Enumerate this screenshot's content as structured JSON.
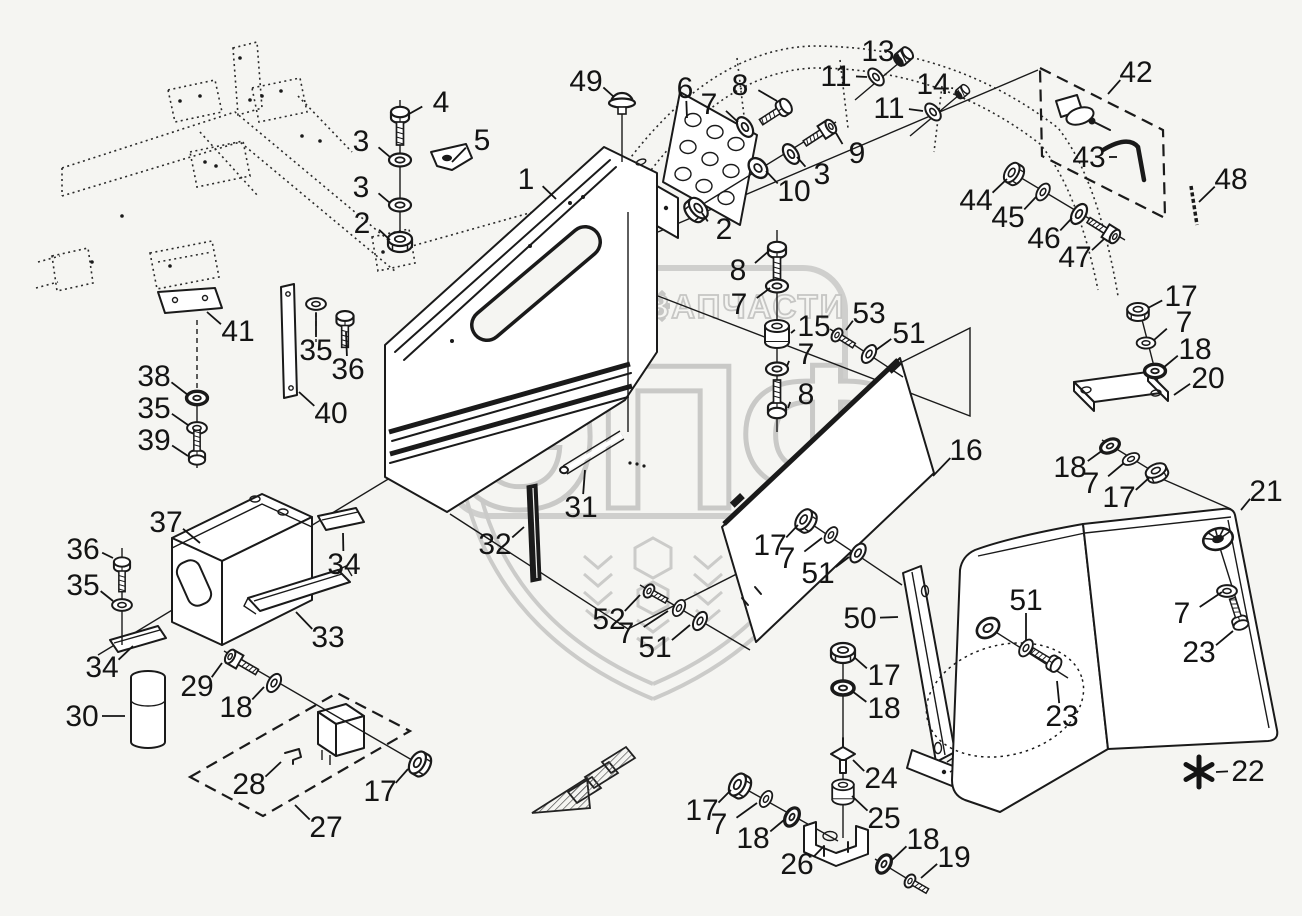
{
  "watermark": {
    "left_text": "ТЕХНИКА",
    "right_text": "ЗАПЧАСТИ",
    "logo_text": "ЭПФ",
    "gear_icon": "⚙",
    "color": "#c9c9c7"
  },
  "diagram": {
    "footnote_marker": "*",
    "line_color": "#1a1a1a",
    "background_color": "#f5f5f2",
    "callouts": [
      {
        "n": "4",
        "x": 441,
        "y": 102,
        "tx": 409,
        "ty": 114
      },
      {
        "n": "5",
        "x": 482,
        "y": 140,
        "tx": 452,
        "ty": 162
      },
      {
        "n": "3",
        "x": 361,
        "y": 141,
        "tx": 390,
        "ty": 157
      },
      {
        "n": "3",
        "x": 361,
        "y": 187,
        "tx": 390,
        "ty": 203
      },
      {
        "n": "2",
        "x": 362,
        "y": 223,
        "tx": 390,
        "ty": 240
      },
      {
        "n": "49",
        "x": 586,
        "y": 81,
        "tx": 614,
        "ty": 97
      },
      {
        "n": "1",
        "x": 526,
        "y": 179,
        "tx": 556,
        "ty": 199
      },
      {
        "n": "6",
        "x": 685,
        "y": 88,
        "tx": 687,
        "ty": 118
      },
      {
        "n": "7",
        "x": 709,
        "y": 104,
        "tx": 738,
        "ty": 122
      },
      {
        "n": "8",
        "x": 740,
        "y": 85,
        "tx": 777,
        "ty": 101
      },
      {
        "n": "9",
        "x": 857,
        "y": 153,
        "tx": 836,
        "ty": 133
      },
      {
        "n": "3",
        "x": 822,
        "y": 174,
        "tx": 797,
        "ty": 157
      },
      {
        "n": "10",
        "x": 794,
        "y": 191,
        "tx": 766,
        "ty": 171
      },
      {
        "n": "2",
        "x": 724,
        "y": 229,
        "tx": 702,
        "ty": 213
      },
      {
        "n": "8",
        "x": 738,
        "y": 270,
        "tx": 770,
        "ty": 250
      },
      {
        "n": "7",
        "x": 739,
        "y": 304,
        "tx": 770,
        "ty": 288
      },
      {
        "n": "15",
        "x": 814,
        "y": 326,
        "tx": 791,
        "ty": 333
      },
      {
        "n": "7",
        "x": 806,
        "y": 354,
        "tx": 787,
        "ty": 366
      },
      {
        "n": "8",
        "x": 806,
        "y": 394,
        "tx": 788,
        "ty": 408
      },
      {
        "n": "53",
        "x": 869,
        "y": 313,
        "tx": 846,
        "ty": 330
      },
      {
        "n": "51",
        "x": 909,
        "y": 333,
        "tx": 876,
        "ty": 350
      },
      {
        "n": "13",
        "x": 878,
        "y": 51,
        "tx": 897,
        "ty": 56
      },
      {
        "n": "11",
        "x": 836,
        "y": 76,
        "tx": 867,
        "ty": 77
      },
      {
        "n": "14",
        "x": 933,
        "y": 84,
        "tx": 952,
        "ty": 89
      },
      {
        "n": "11",
        "x": 889,
        "y": 108,
        "tx": 923,
        "ty": 111
      },
      {
        "n": "42",
        "x": 1136,
        "y": 72,
        "tx": 1108,
        "ty": 94
      },
      {
        "n": "43",
        "x": 1089,
        "y": 157,
        "tx": 1117,
        "ty": 157
      },
      {
        "n": "48",
        "x": 1231,
        "y": 179,
        "tx": 1199,
        "ty": 202
      },
      {
        "n": "44",
        "x": 976,
        "y": 200,
        "tx": 1007,
        "ty": 179
      },
      {
        "n": "45",
        "x": 1008,
        "y": 217,
        "tx": 1036,
        "ty": 197
      },
      {
        "n": "46",
        "x": 1044,
        "y": 238,
        "tx": 1072,
        "ty": 218
      },
      {
        "n": "47",
        "x": 1075,
        "y": 257,
        "tx": 1104,
        "ty": 239
      },
      {
        "n": "17",
        "x": 1181,
        "y": 296,
        "tx": 1148,
        "ty": 308
      },
      {
        "n": "7",
        "x": 1184,
        "y": 322,
        "tx": 1154,
        "ty": 340
      },
      {
        "n": "18",
        "x": 1195,
        "y": 349,
        "tx": 1163,
        "ty": 368
      },
      {
        "n": "20",
        "x": 1208,
        "y": 378,
        "tx": 1174,
        "ty": 395
      },
      {
        "n": "18",
        "x": 1070,
        "y": 467,
        "tx": 1103,
        "ty": 450
      },
      {
        "n": "7",
        "x": 1091,
        "y": 483,
        "tx": 1124,
        "ty": 463
      },
      {
        "n": "17",
        "x": 1119,
        "y": 497,
        "tx": 1150,
        "ty": 477
      },
      {
        "n": "16",
        "x": 966,
        "y": 450,
        "tx": 933,
        "ty": 476
      },
      {
        "n": "21",
        "x": 1266,
        "y": 491,
        "tx": 1241,
        "ty": 510
      },
      {
        "n": "51",
        "x": 1026,
        "y": 600,
        "tx": 1026,
        "ty": 640
      },
      {
        "n": "7",
        "x": 1182,
        "y": 613,
        "tx": 1222,
        "ty": 592
      },
      {
        "n": "23",
        "x": 1199,
        "y": 652,
        "tx": 1233,
        "ty": 631
      },
      {
        "n": "23",
        "x": 1062,
        "y": 716,
        "tx": 1057,
        "ty": 681
      },
      {
        "n": "22",
        "x": 1248,
        "y": 771,
        "tx": 1216,
        "ty": 772
      },
      {
        "n": "41",
        "x": 238,
        "y": 331,
        "tx": 207,
        "ty": 312
      },
      {
        "n": "35",
        "x": 316,
        "y": 350,
        "tx": 316,
        "ty": 313
      },
      {
        "n": "36",
        "x": 348,
        "y": 369,
        "tx": 346,
        "ty": 332
      },
      {
        "n": "40",
        "x": 331,
        "y": 413,
        "tx": 299,
        "ty": 392
      },
      {
        "n": "38",
        "x": 154,
        "y": 376,
        "tx": 188,
        "ty": 395
      },
      {
        "n": "35",
        "x": 154,
        "y": 408,
        "tx": 188,
        "ty": 425
      },
      {
        "n": "39",
        "x": 154,
        "y": 440,
        "tx": 188,
        "ty": 456
      },
      {
        "n": "37",
        "x": 166,
        "y": 522,
        "tx": 200,
        "ty": 543
      },
      {
        "n": "34",
        "x": 344,
        "y": 564,
        "tx": 343,
        "ty": 533
      },
      {
        "n": "36",
        "x": 83,
        "y": 549,
        "tx": 113,
        "ty": 558
      },
      {
        "n": "35",
        "x": 83,
        "y": 585,
        "tx": 113,
        "ty": 601
      },
      {
        "n": "34",
        "x": 102,
        "y": 667,
        "tx": 133,
        "ty": 646
      },
      {
        "n": "33",
        "x": 328,
        "y": 637,
        "tx": 296,
        "ty": 612
      },
      {
        "n": "30",
        "x": 82,
        "y": 716,
        "tx": 125,
        "ty": 716
      },
      {
        "n": "29",
        "x": 197,
        "y": 686,
        "tx": 222,
        "ty": 663
      },
      {
        "n": "18",
        "x": 236,
        "y": 707,
        "tx": 264,
        "ty": 687
      },
      {
        "n": "28",
        "x": 249,
        "y": 784,
        "tx": 281,
        "ty": 762
      },
      {
        "n": "17",
        "x": 380,
        "y": 791,
        "tx": 408,
        "ty": 769
      },
      {
        "n": "27",
        "x": 326,
        "y": 827,
        "tx": 295,
        "ty": 805
      },
      {
        "n": "31",
        "x": 581,
        "y": 507,
        "tx": 585,
        "ty": 470
      },
      {
        "n": "32",
        "x": 495,
        "y": 544,
        "tx": 524,
        "ty": 527
      },
      {
        "n": "52",
        "x": 609,
        "y": 619,
        "tx": 640,
        "ty": 595
      },
      {
        "n": "7",
        "x": 626,
        "y": 633,
        "tx": 668,
        "ty": 611
      },
      {
        "n": "51",
        "x": 655,
        "y": 647,
        "tx": 690,
        "ty": 625
      },
      {
        "n": "17",
        "x": 770,
        "y": 545,
        "tx": 798,
        "ty": 525
      },
      {
        "n": "7",
        "x": 787,
        "y": 558,
        "tx": 822,
        "ty": 538
      },
      {
        "n": "51",
        "x": 818,
        "y": 573,
        "tx": 849,
        "ty": 557
      },
      {
        "n": "50",
        "x": 860,
        "y": 618,
        "tx": 898,
        "ty": 617
      },
      {
        "n": "17",
        "x": 884,
        "y": 675,
        "tx": 854,
        "ty": 657
      },
      {
        "n": "18",
        "x": 884,
        "y": 708,
        "tx": 852,
        "ty": 691
      },
      {
        "n": "24",
        "x": 881,
        "y": 778,
        "tx": 853,
        "ty": 760
      },
      {
        "n": "25",
        "x": 884,
        "y": 818,
        "tx": 852,
        "ty": 796
      },
      {
        "n": "17",
        "x": 702,
        "y": 810,
        "tx": 731,
        "ty": 790
      },
      {
        "n": "7",
        "x": 719,
        "y": 824,
        "tx": 757,
        "ty": 803
      },
      {
        "n": "18",
        "x": 753,
        "y": 838,
        "tx": 784,
        "ty": 820
      },
      {
        "n": "26",
        "x": 797,
        "y": 864,
        "tx": 824,
        "ty": 846
      },
      {
        "n": "18",
        "x": 923,
        "y": 839,
        "tx": 892,
        "ty": 860
      },
      {
        "n": "19",
        "x": 954,
        "y": 857,
        "tx": 921,
        "ty": 878
      }
    ]
  }
}
